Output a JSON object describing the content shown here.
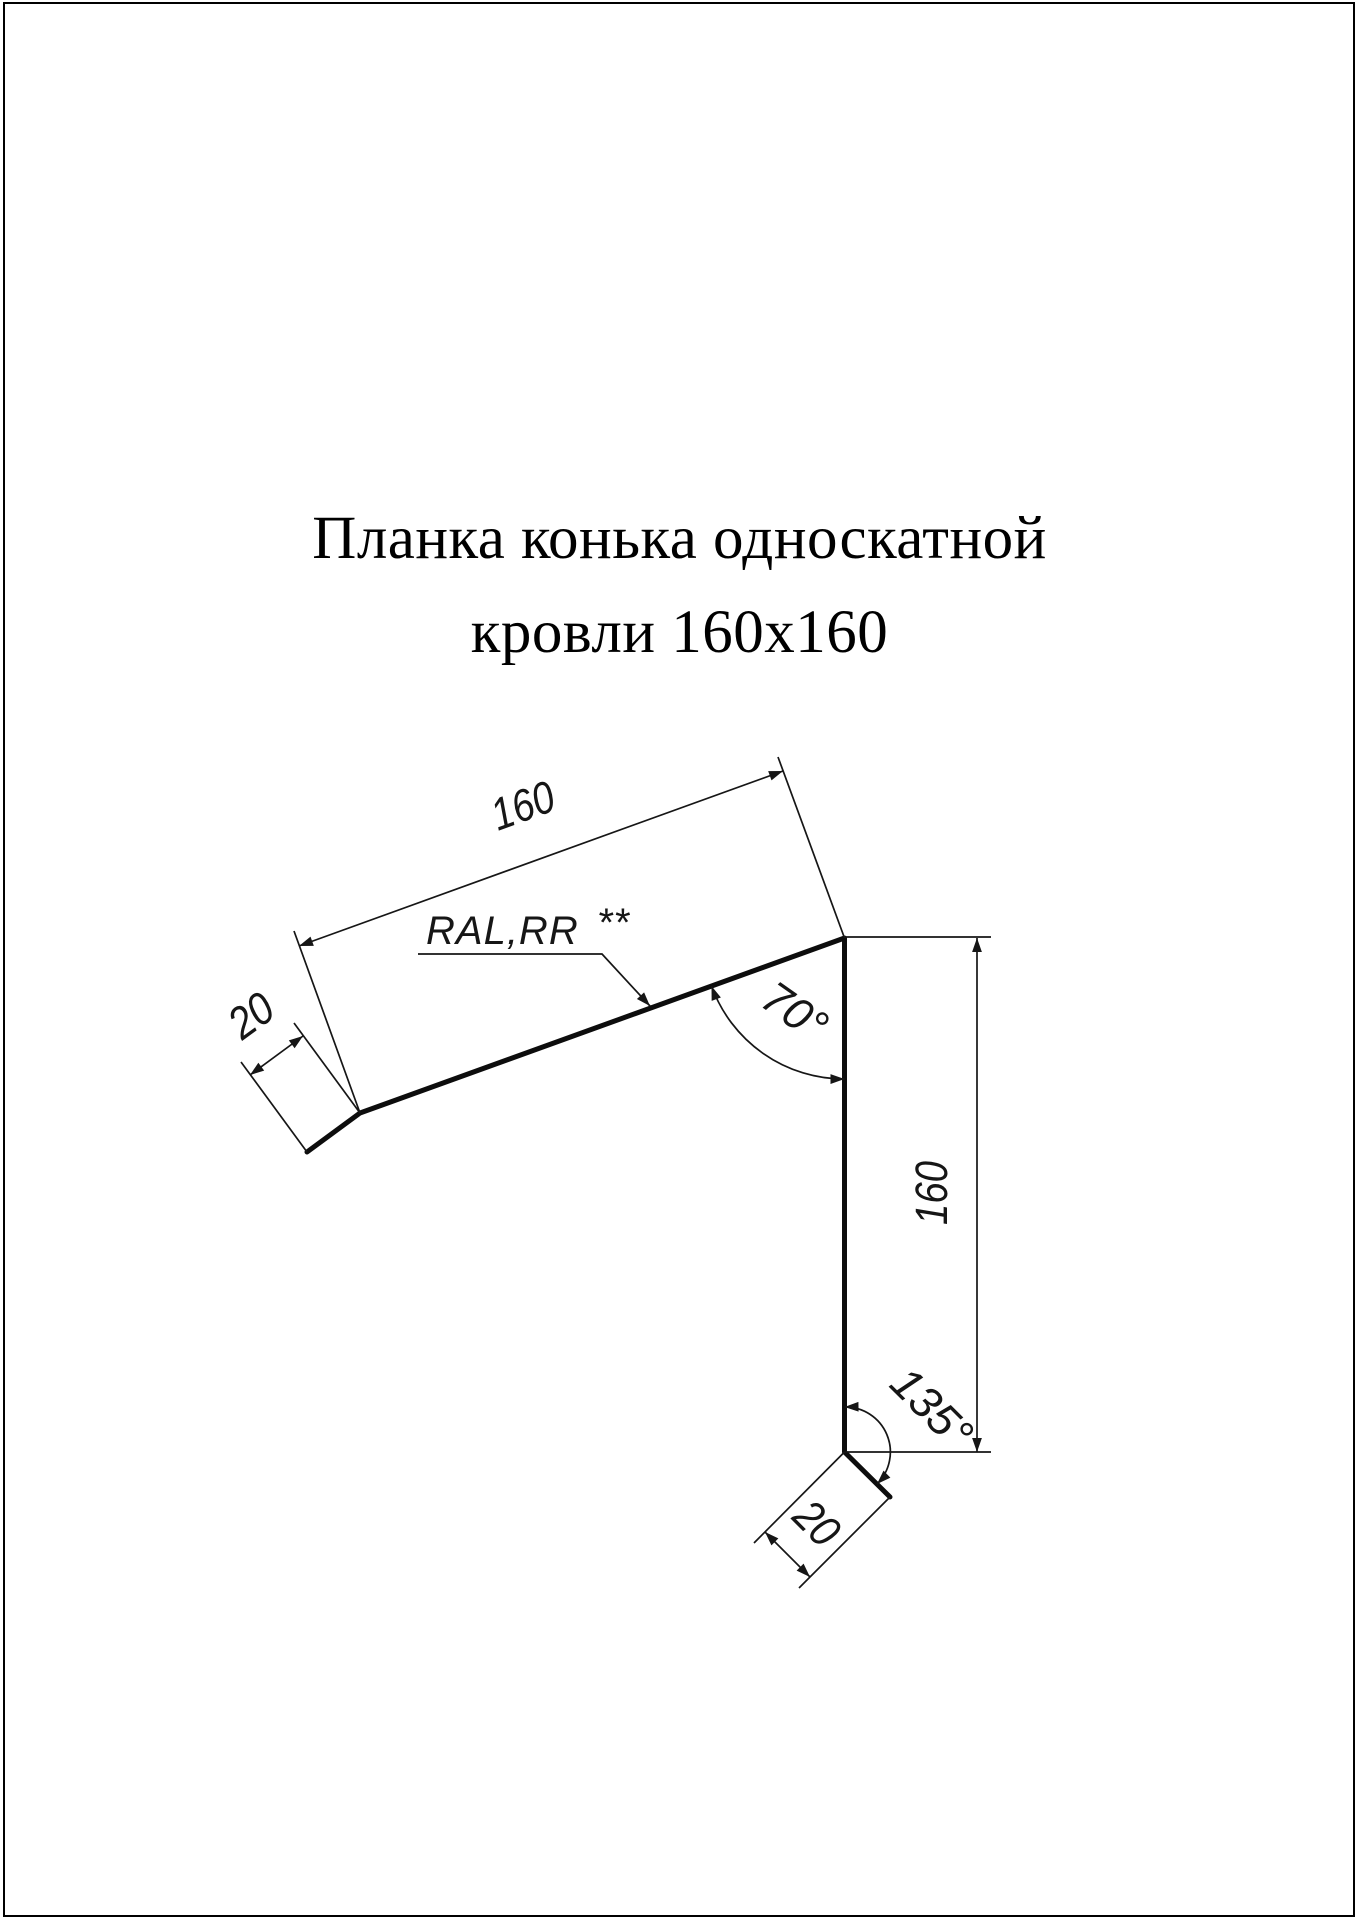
{
  "title": {
    "line1": "Планка конька односкатной",
    "line2": "кровли 160х160"
  },
  "drawing": {
    "dim_top_length": "160",
    "dim_top_hem": "20",
    "angle_top": "70°",
    "dim_side_length": "160",
    "angle_bottom": "135°",
    "dim_bottom_hem": "20",
    "material_label": {
      "text": "RAL,RR",
      "stars": "**"
    }
  },
  "colors": {
    "line": "#0d0d0d",
    "background": "#ffffff"
  }
}
